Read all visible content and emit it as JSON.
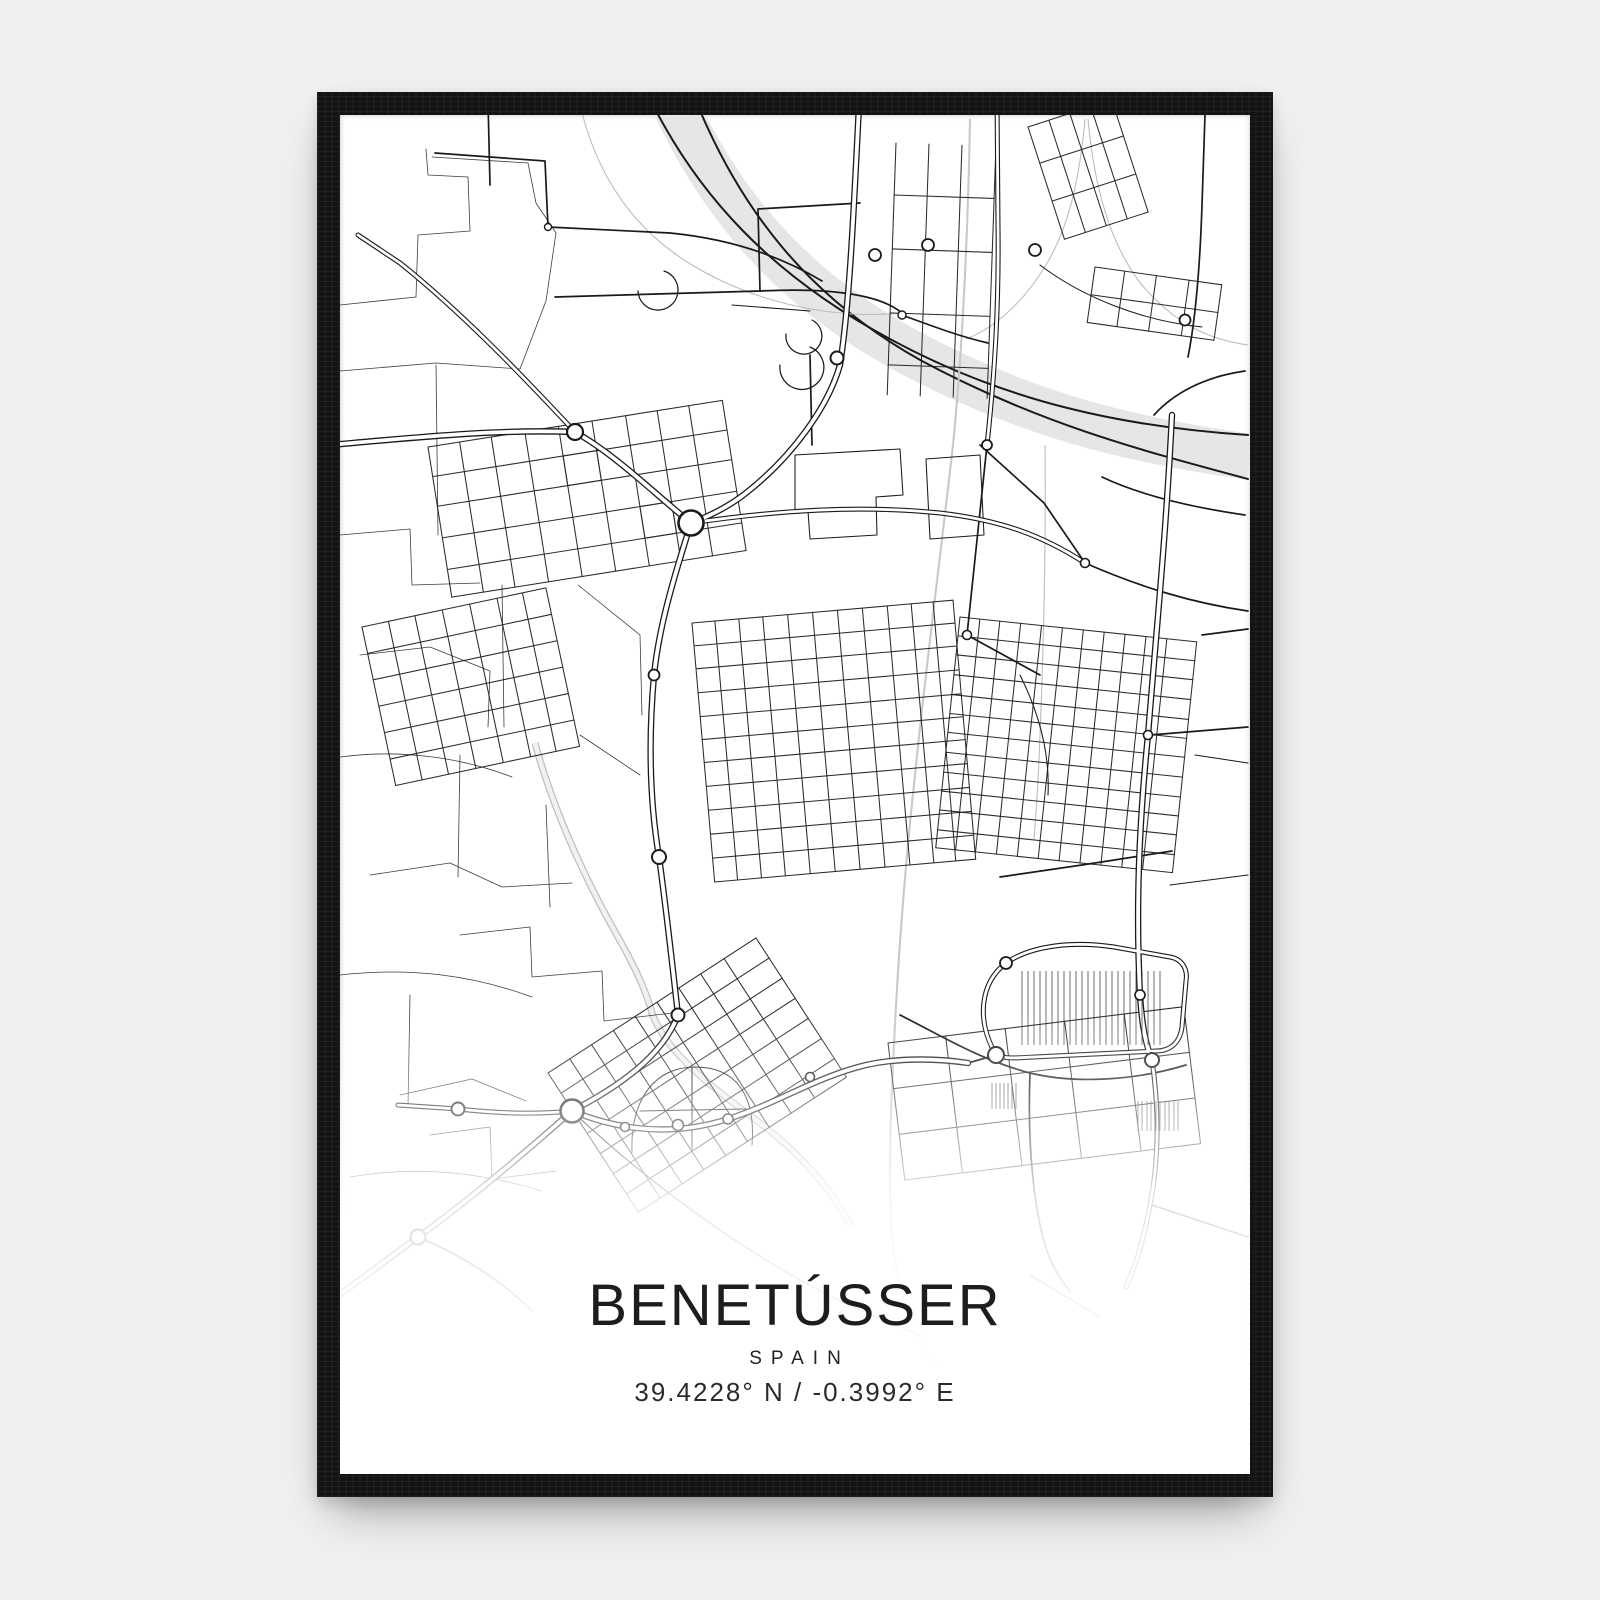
{
  "scene": {
    "description": "framed city map poster product image",
    "background_color": "#eff0f1",
    "frame_color": "#131313",
    "paper_color": "#ffffff"
  },
  "poster": {
    "title": "BENETÚSSER",
    "country": "SPAIN",
    "coordinates": "39.4228° N / -0.3992° E",
    "text_color": "#1d1d1d"
  },
  "map": {
    "style": "minimal black and white street map with river band, roundabouts and dense street grids",
    "road_color": "#1a1a1a",
    "river_color": "#e6e6e6",
    "railway_color": "#c9c9c9",
    "faint_color": "#bdbdbd"
  }
}
